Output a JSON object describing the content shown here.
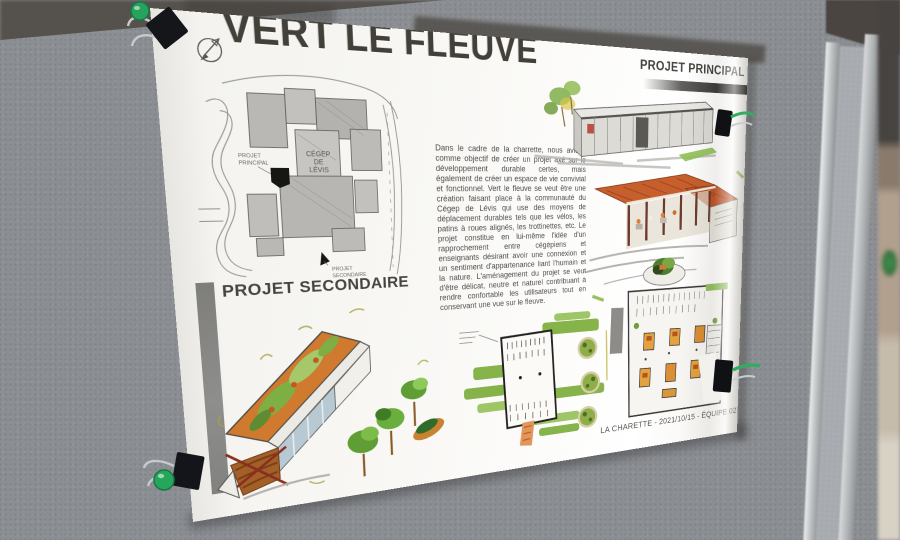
{
  "poster": {
    "title": "VERT LE FLEUVE",
    "sections": {
      "principal_label": "PROJET PRINCIPAL",
      "secondaire_label": "PROJET SECONDAIRE"
    },
    "description": "Dans le cadre de la charrette, nous avions comme objectif de créer un projet axé sur le développement durable certes, mais également de créer un espace de vie convivial et fonctionnel. Vert le fleuve se veut être une création faisant place à la communauté du Cégep de Lévis qui use des moyens de déplacement durables tels que les vélos, les patins à roues alignés, les trottinettes, etc. Le projet constitue en lui-même l'idée d'un rapprochement entre cégépiens et enseignants désirant avoir une connexion et un sentiment d'appartenance liant l'humain et la nature. L'aménagement du projet se veut d'être délicat, neutre et naturel contribuant à rendre confortable les utilisateurs tout en conservant une vue sur le fleuve.",
    "footer": "LA CHARETTE - 2021/10/15 - ÉQUIPE 02",
    "site_plan": {
      "cegep_line1": "CÉGEP",
      "cegep_line2": "DE",
      "cegep_line3": "LÉVIS",
      "principal_line1": "PROJET",
      "principal_line2": "PRINCIPAL",
      "secondaire_line1": "PROJET",
      "secondaire_line2": "SECONDAIRE"
    },
    "colors": {
      "felt_board": "#8b8e92",
      "marker_green": "#7cae3c",
      "terracotta_roof": "#c75f2d",
      "wood": "#a35f28",
      "clip_green": "#26a65b",
      "title_ink": "#434039"
    }
  }
}
